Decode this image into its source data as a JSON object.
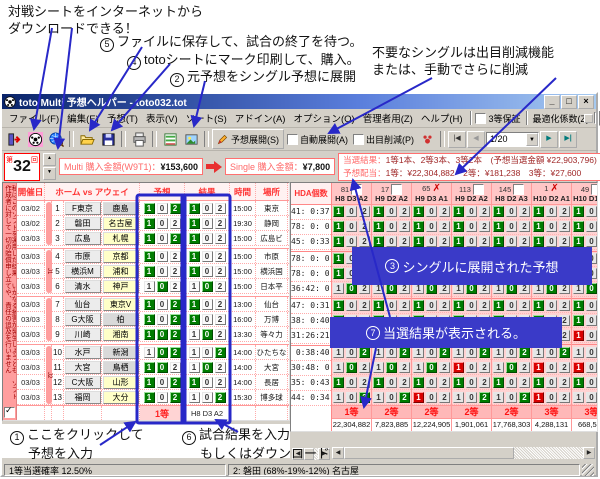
{
  "annotations": {
    "top_left_1": "対戦シートをインターネットから",
    "top_left_2": "ダウンロードできる！",
    "top_right_1": "不要なシングルは出目削減機能",
    "top_right_2": "または、手動でさらに削減",
    "s2": {
      "n": "2",
      "t": "元予想をシングル予想に展開"
    },
    "s3": {
      "n": "3",
      "t": "シングルに展開された予想"
    },
    "s4": {
      "n": "4",
      "t": "totoシートにマーク印刷して、購入。"
    },
    "s5": {
      "n": "5",
      "t": "ファイルに保存して、試合の終了を待つ。"
    },
    "s7": {
      "n": "7",
      "t": "当選結果が表示される。"
    },
    "s1": {
      "n": "1",
      "t1": "ここをクリックして",
      "t2": "予想を入力"
    },
    "s6": {
      "n": "6",
      "t1": "試合結果を入力",
      "t2": "もしくはダウンロード"
    }
  },
  "window": {
    "title": "toto Multi 予想ヘルパー - toto032.tot",
    "controls": {
      "min": "_",
      "max": "□",
      "close": "×"
    },
    "menus": [
      "ファイル(F)",
      "編集(E)",
      "予想(T)",
      "表示(V)",
      "ソート(S)",
      "アドイン(A)",
      "オプション(O)",
      "管理者用(Z)",
      "ヘルプ(H)"
    ],
    "menu_right": {
      "guarantee": "3等保証",
      "optimize": "最適化係数(Z)",
      "zoom": "100%"
    },
    "toolbar": {
      "expand": "予想展開(S)",
      "auto": "自動展開(A)",
      "reduce": "出目削減(P)",
      "nav": "1/20"
    },
    "info": {
      "round_prefix": "第",
      "round": "32",
      "round_suffix": "回",
      "multi_label": "Multi 購入金額(W9T1)：",
      "multi_value": "¥153,600",
      "single_label": "Single 購入金額：",
      "single_value": "¥7,800",
      "result_label": "当選結果：",
      "result_value": "1等1本、2等3本、3等2本　(予想当選金額 ¥22,903,796)",
      "payout_label": "予想配当：",
      "payout_value": "1等：¥22,304,882　2等：¥181,238　3等：¥27,600"
    }
  },
  "left_table": {
    "disclaimer": "私はこのソフトを運用した結果、いかなる損害が発生しようとも、ソフト作成者に対して一切の賠償申し立てや、責任の追及を行いません",
    "headers": {
      "date": "開催日",
      "teams": "ホーム vs アウェイ",
      "pred": "予想",
      "res": "結果",
      "time": "時間",
      "place": "場所"
    },
    "rows": [
      {
        "date": "03/02",
        "num": "1",
        "home": "F東京",
        "away": "鹿島",
        "ab": "g",
        "pred": [
          "1",
          "2"
        ],
        "time": "15:00",
        "place": "東京"
      },
      {
        "date": "03/02",
        "num": "2",
        "home": "磐田",
        "away": "名古屋",
        "ab": "y",
        "pred": [
          "1"
        ],
        "time": "19:30",
        "place": "静岡"
      },
      {
        "date": "03/03",
        "num": "3",
        "home": "広島",
        "away": "札幌",
        "ab": "y",
        "pred": [
          "1",
          "2"
        ],
        "time": "15:00",
        "place": "広島ビ"
      },
      {
        "date": "03/03",
        "num": "4",
        "home": "市原",
        "away": "京都",
        "ab": "y",
        "pred": [
          "1"
        ],
        "time": "15:00",
        "place": "市原"
      },
      {
        "date": "03/03",
        "num": "5",
        "home": "横浜M",
        "away": "浦和",
        "ab": "y",
        "pred": [
          "1"
        ],
        "time": "15:00",
        "place": "横浜国"
      },
      {
        "date": "03/03",
        "num": "6",
        "home": "清水",
        "away": "神戸",
        "ab": "y",
        "pred": [
          "0"
        ],
        "time": "15:00",
        "place": "日本平"
      },
      {
        "date": "03/03",
        "num": "7",
        "home": "仙台",
        "away": "東京V",
        "ab": "y",
        "pred": [
          "1",
          "2"
        ],
        "time": "13:00",
        "place": "仙台"
      },
      {
        "date": "03/03",
        "num": "8",
        "home": "G大阪",
        "away": "柏",
        "ab": "g",
        "pred": [
          "1",
          "2"
        ],
        "time": "16:00",
        "place": "万博"
      },
      {
        "date": "03/03",
        "num": "9",
        "home": "川崎",
        "away": "湘南",
        "ab": "y",
        "pred": [
          "1",
          "0",
          "2"
        ],
        "time": "13:30",
        "place": "等々力"
      },
      {
        "date": "03/03",
        "num": "10",
        "home": "水戸",
        "away": "新潟",
        "ab": "g",
        "pred": [
          "0",
          "2"
        ],
        "time": "14:00",
        "place": "ひたちな"
      },
      {
        "date": "03/03",
        "num": "11",
        "home": "大宮",
        "away": "鳥栖",
        "ab": "g",
        "pred": [
          "1",
          "0"
        ],
        "time": "14:00",
        "place": "大宮"
      },
      {
        "date": "03/03",
        "num": "12",
        "home": "C大阪",
        "away": "山形",
        "ab": "y",
        "pred": [
          "1",
          "2"
        ],
        "time": "14:00",
        "place": "長居"
      },
      {
        "date": "03/03",
        "num": "13",
        "home": "福岡",
        "away": "大分",
        "ab": "y",
        "pred": [
          "1",
          "2"
        ],
        "time": "15:30",
        "place": "博多球"
      }
    ],
    "results": [
      "1",
      "1",
      "1",
      "1",
      "1",
      "0",
      "1",
      "1",
      "0",
      "2",
      "0",
      "1",
      "2"
    ],
    "bands": [
      {
        "s": 1,
        "e": 3,
        "label": ""
      },
      {
        "s": 4,
        "e": 6,
        "label": "J1"
      },
      {
        "s": 7,
        "e": 9,
        "label": ""
      },
      {
        "s": 10,
        "e": 13,
        "label": "J2"
      }
    ],
    "footer": {
      "rank": "1等",
      "tally": "H8 D3 A2"
    }
  },
  "right_panel": {
    "hda_header": "HDA個数",
    "hda": [
      "41: 0:37",
      "78: 0: 0",
      "45: 0:33",
      "78: 0: 0",
      "78: 0: 0",
      "36:42: 0",
      "47: 0:31",
      "38: 0:40",
      "31:26:21",
      " 0:38:40",
      "30:48: 0",
      "35: 0:43",
      "44: 0:34"
    ],
    "columns": [
      {
        "num": "81",
        "mark": "box",
        "label": "H8 D3 A2",
        "wrong": {},
        "rank": "1等",
        "prize": "22,304,882"
      },
      {
        "num": "17",
        "mark": "box",
        "label": "H9 D2 A2",
        "wrong": {
          "9": "1"
        },
        "rank": "2等",
        "prize": "7,823,885"
      },
      {
        "num": "65",
        "mark": "x",
        "label": "H9 D3 A1",
        "wrong": {
          "13": "1"
        },
        "rank": "2等",
        "prize": "12,224,905"
      },
      {
        "num": "113",
        "mark": "box",
        "label": "H9 D2 A2",
        "wrong": {
          "11": "1"
        },
        "rank": "2等",
        "prize": "1,901,061"
      },
      {
        "num": "145",
        "mark": "box",
        "label": "H8 D2 A3",
        "wrong": {
          "9": "2"
        },
        "rank": "2等",
        "prize": "17,768,303"
      },
      {
        "num": "1",
        "mark": "x",
        "label": "H10 D2 A1",
        "wrong": {
          "11": "1",
          "13": "1"
        },
        "rank": "3等",
        "prize": "4,288,131"
      },
      {
        "num": "49",
        "mark": "box",
        "label": "H10 D1 A2",
        "w滅": "",
        "wrong": {
          "9": "1",
          "11": "1"
        },
        "rank": "3等",
        "prize": "668,540"
      }
    ]
  },
  "status": {
    "left": "1等当選確率 12.50%",
    "mid": "2: 磐田 (68%-19%-12%) 名古屋"
  }
}
